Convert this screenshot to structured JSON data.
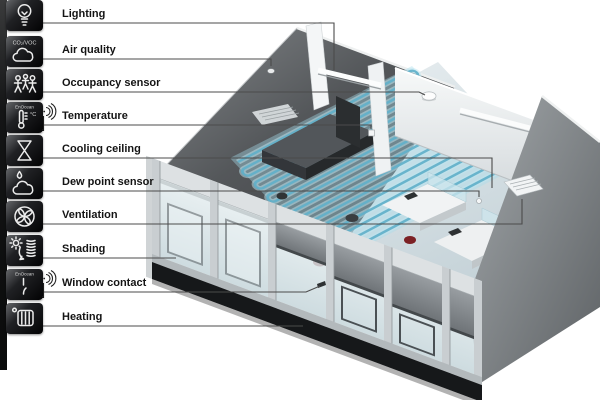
{
  "sidebar": {
    "items": [
      {
        "label": "Lighting",
        "icon": "light-bulb-icon"
      },
      {
        "label": "Air quality",
        "icon": "air-quality-cloud-icon",
        "icon_text": "CO₂/VOC"
      },
      {
        "label": "Occupancy sensor",
        "icon": "occupancy-people-icon"
      },
      {
        "label": "Temperature",
        "icon": "thermometer-icon",
        "icon_text": "EnOcean",
        "icon_unit": "°C",
        "wireless": true
      },
      {
        "label": "Cooling ceiling",
        "icon": "hourglass-icon"
      },
      {
        "label": "Dew point sensor",
        "icon": "dew-point-icon"
      },
      {
        "label": "Ventilation",
        "icon": "fan-icon"
      },
      {
        "label": "Shading",
        "icon": "sun-blinds-icon"
      },
      {
        "label": "Window contact",
        "icon": "window-contact-icon",
        "icon_text": "EnOcean",
        "wireless": true
      },
      {
        "label": "Heating",
        "icon": "radiator-icon"
      }
    ]
  },
  "colors": {
    "background": "#ffffff",
    "icon_tile": "#0c0c0d",
    "label_text": "#141414",
    "leader_line": "#4b4b4b",
    "coil_accent": "#5fafc9",
    "dark_wall": "#4a4d50",
    "chair_red": "#7a2226"
  }
}
